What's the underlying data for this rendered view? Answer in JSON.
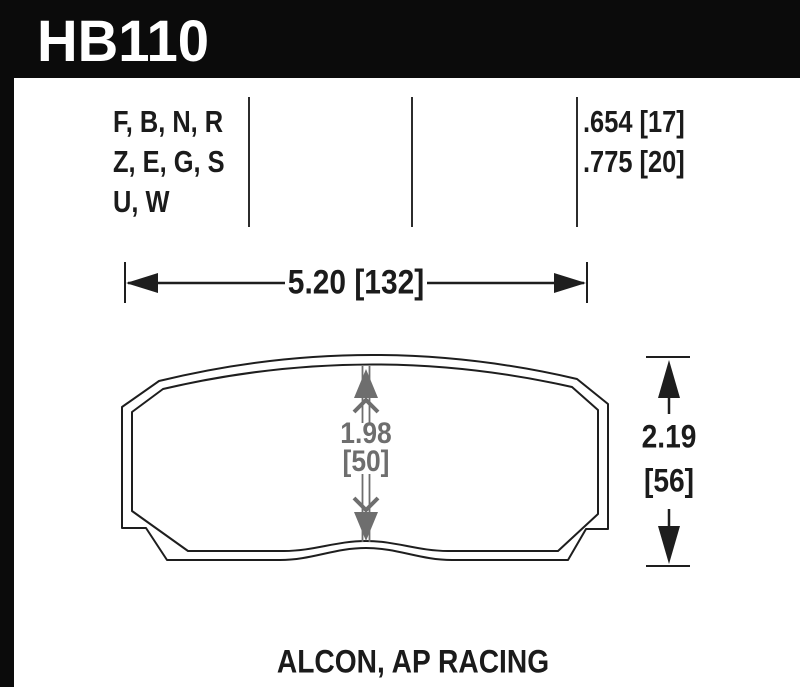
{
  "header": {
    "part_number": "HB110",
    "bg_color": "#0b0b0b",
    "text_color": "#ffffff"
  },
  "compounds": {
    "lines": [
      "F, B, N, R",
      "Z, E, G, S",
      "U, W"
    ]
  },
  "thickness": {
    "lines": [
      ".654 [17]",
      ".775 [20]"
    ]
  },
  "dimensions": {
    "width": "5.20 [132]",
    "center_height_in": "1.98",
    "center_height_mm": "[50]",
    "overall_height_in": "2.19",
    "overall_height_mm": "[56]"
  },
  "caption": "ALCON, AP RACING",
  "colors": {
    "ink": "#1e1e1e",
    "dimension_gray": "#6e6e6e"
  }
}
